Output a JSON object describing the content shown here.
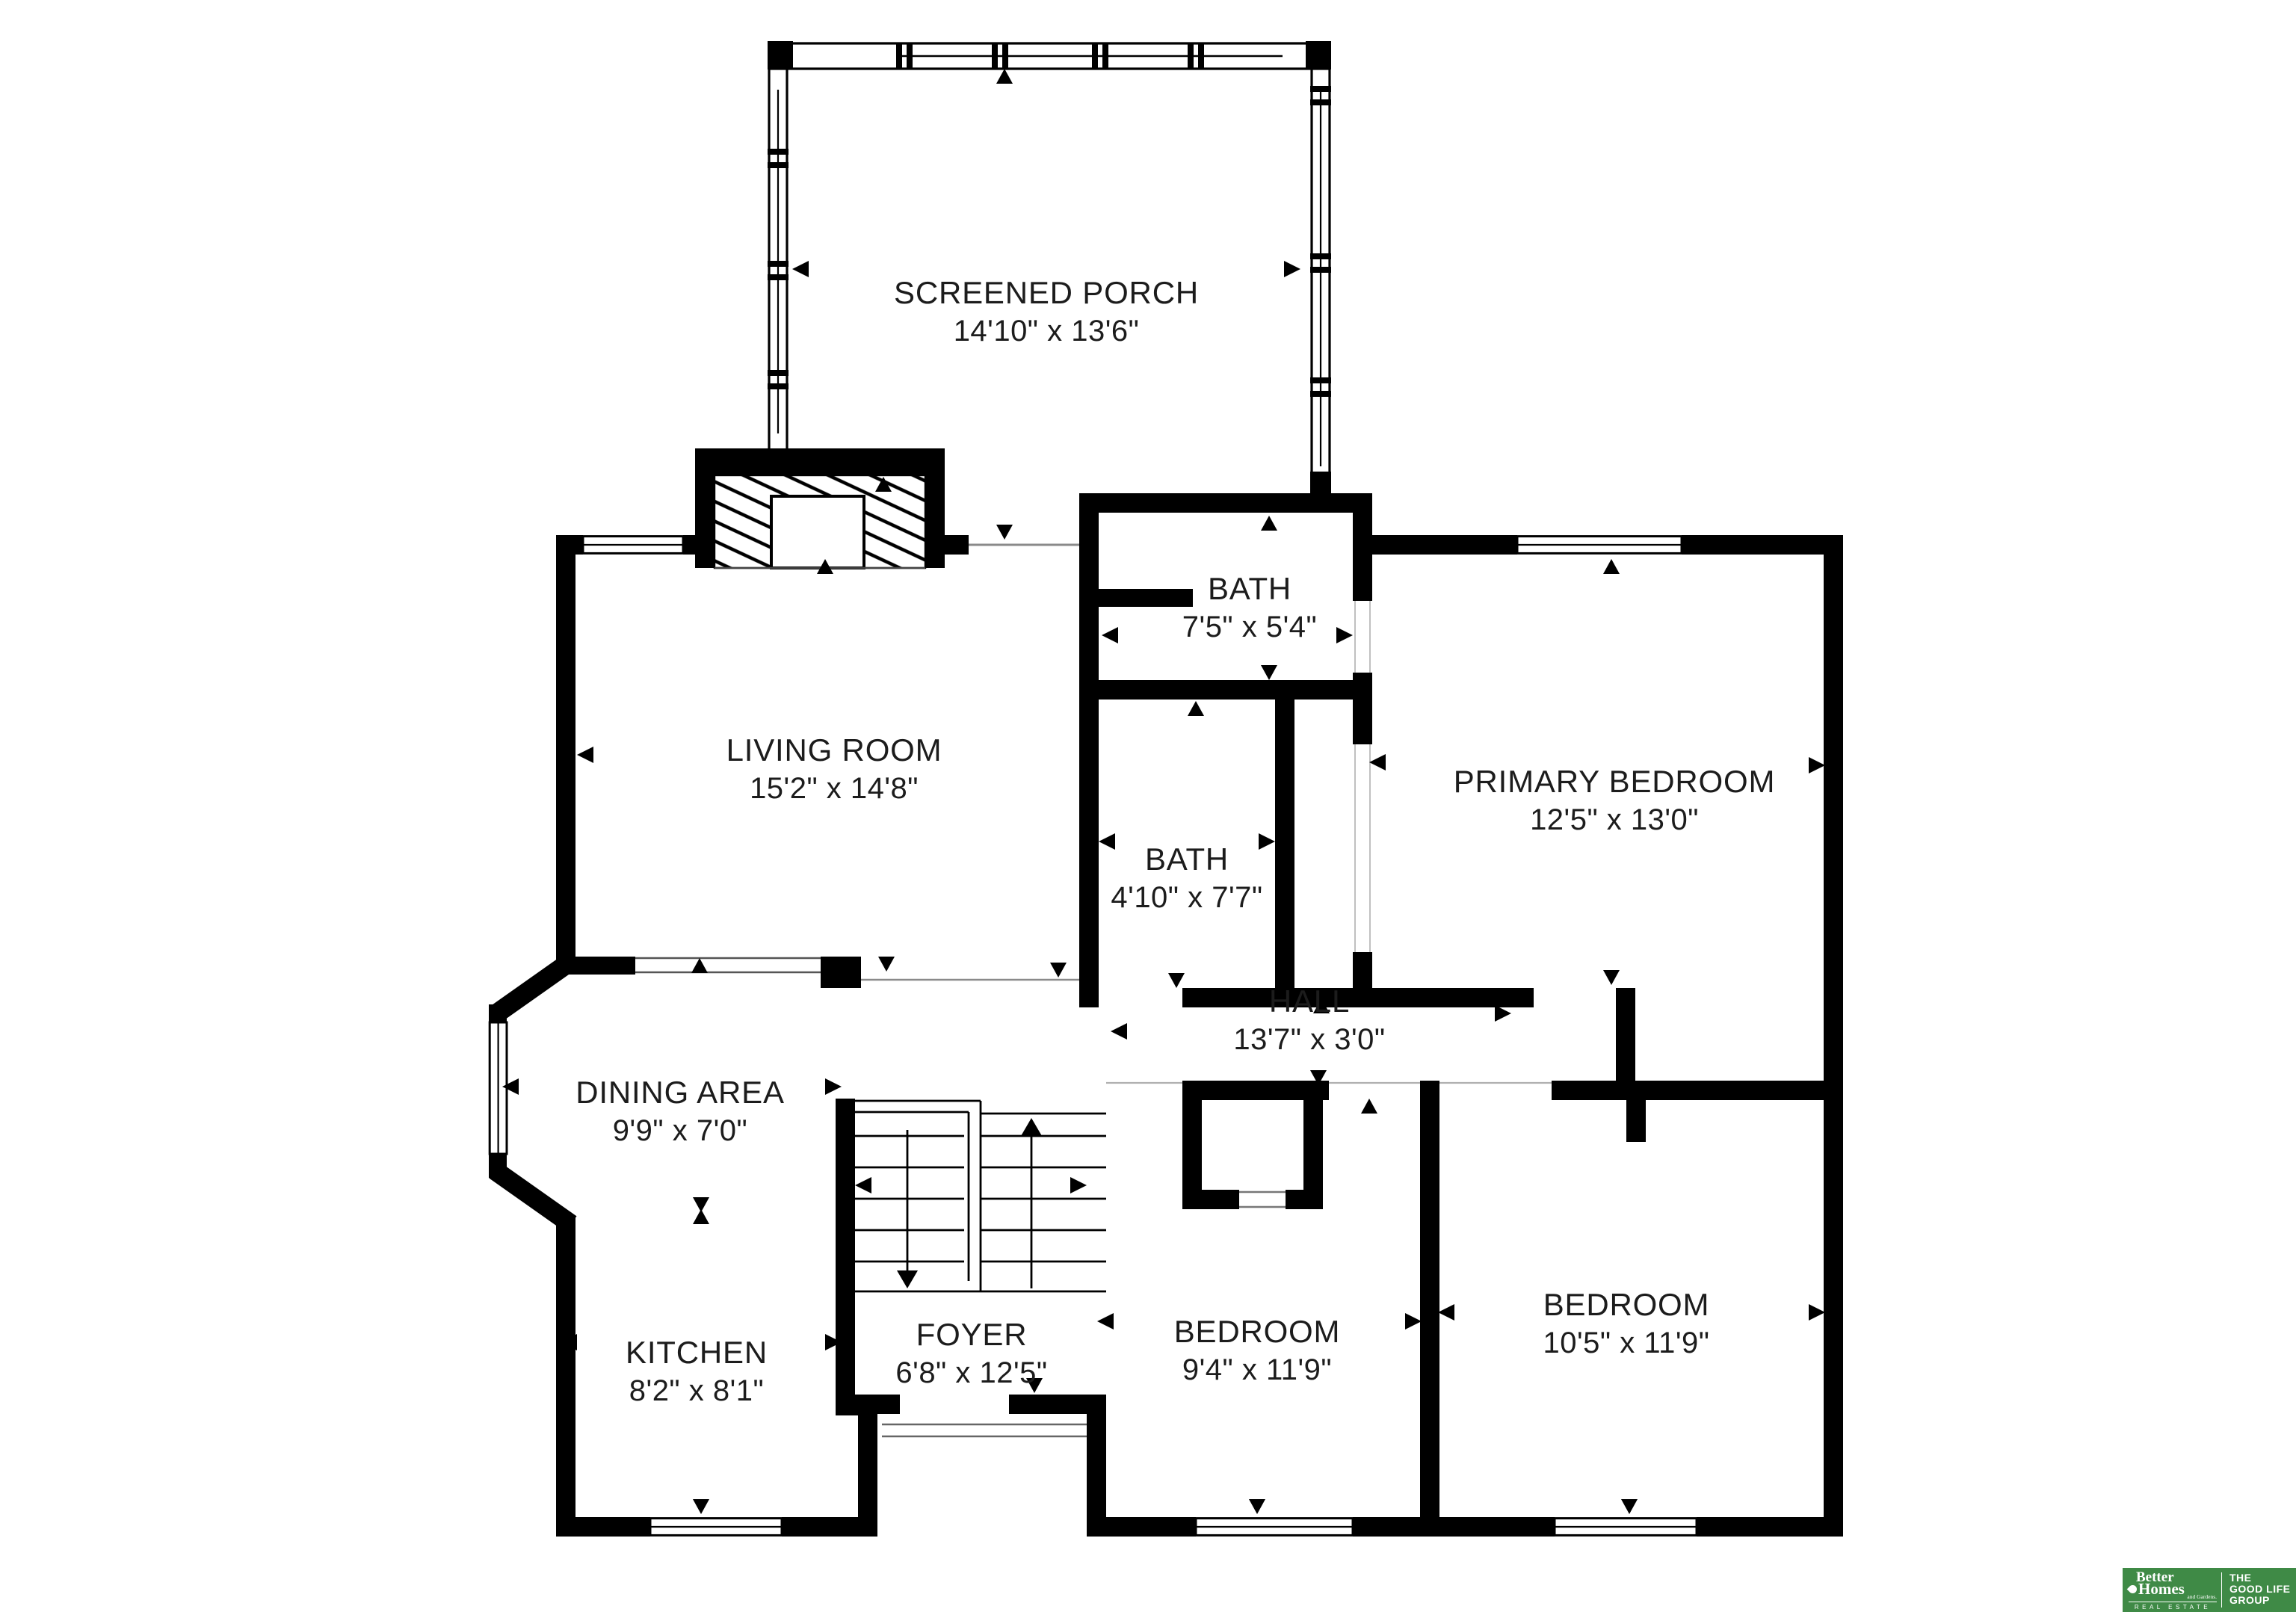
{
  "rooms": [
    {
      "id": "screened-porch",
      "name": "SCREENED PORCH",
      "dims": "14'10\" x 13'6\""
    },
    {
      "id": "living-room",
      "name": "LIVING ROOM",
      "dims": "15'2\" x 14'8\""
    },
    {
      "id": "bath-top",
      "name": "BATH",
      "dims": "7'5\" x 5'4\""
    },
    {
      "id": "primary-bedroom",
      "name": "PRIMARY BEDROOM",
      "dims": "12'5\" x 13'0\""
    },
    {
      "id": "bath-hall",
      "name": "BATH",
      "dims": "4'10\" x 7'7\""
    },
    {
      "id": "hall",
      "name": "HALL",
      "dims": "13'7\" x 3'0\""
    },
    {
      "id": "dining-area",
      "name": "DINING AREA",
      "dims": "9'9\" x 7'0\""
    },
    {
      "id": "kitchen",
      "name": "KITCHEN",
      "dims": "8'2\" x 8'1\""
    },
    {
      "id": "foyer",
      "name": "FOYER",
      "dims": "6'8\" x 12'5\""
    },
    {
      "id": "bedroom-left",
      "name": "BEDROOM",
      "dims": "9'4\" x 11'9\""
    },
    {
      "id": "bedroom-right",
      "name": "BEDROOM",
      "dims": "10'5\" x 11'9\""
    }
  ],
  "logo": {
    "line1": "Better",
    "line2": "Homes",
    "line3": "and Gardens.",
    "subtext": "REAL ESTATE",
    "tagline1": "THE",
    "tagline2": "GOOD LIFE",
    "tagline3": "GROUP",
    "green": "#3f8a46"
  },
  "colors": {
    "background": "#ffffff",
    "walls": "#000000",
    "label_text": "#1c1c1c"
  }
}
